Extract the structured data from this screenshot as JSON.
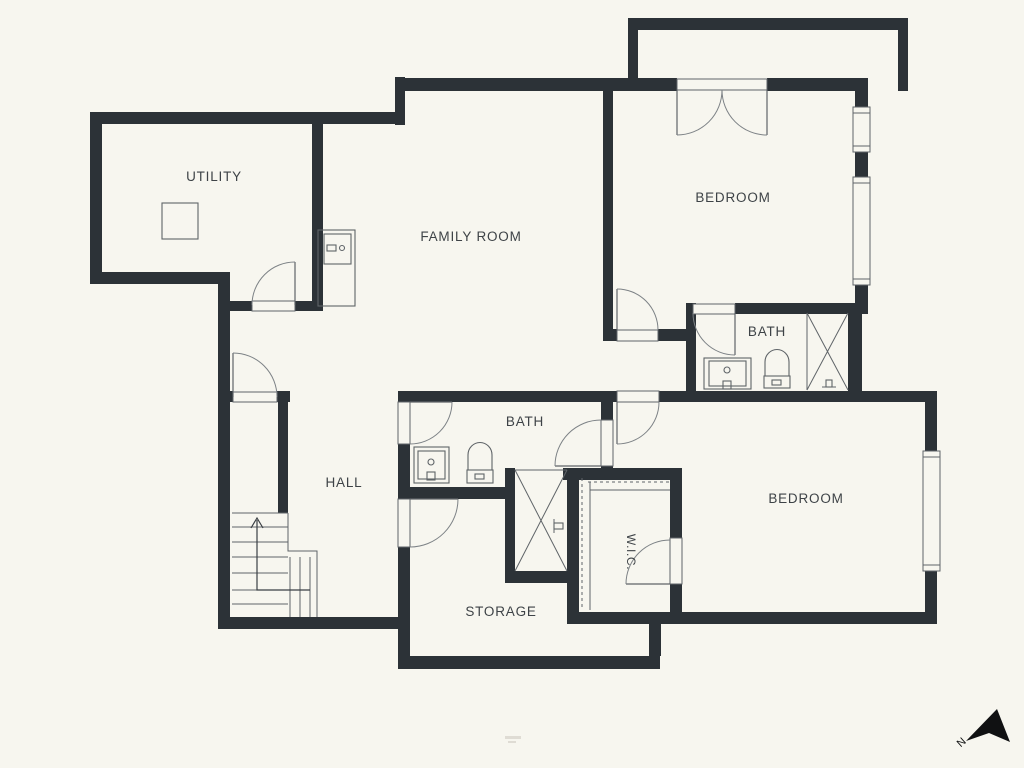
{
  "colors": {
    "background": "#F7F6EF",
    "walls": "#2C3237",
    "fixture_lines": "#5F6468",
    "door_arcs": "#7D8286",
    "label_text": "#3E4347",
    "compass": "#101112"
  },
  "rooms": {
    "utility": {
      "label": "UTILITY"
    },
    "family_room": {
      "label": "FAMILY ROOM"
    },
    "bedroom_top": {
      "label": "BEDROOM"
    },
    "bath_top": {
      "label": "BATH"
    },
    "bath_middle": {
      "label": "BATH"
    },
    "hall": {
      "label": "HALL"
    },
    "bedroom_bottom": {
      "label": "BEDROOM"
    },
    "wic": {
      "label": "W.I.C."
    },
    "storage": {
      "label": "STORAGE"
    }
  },
  "compass": {
    "label": "N"
  }
}
